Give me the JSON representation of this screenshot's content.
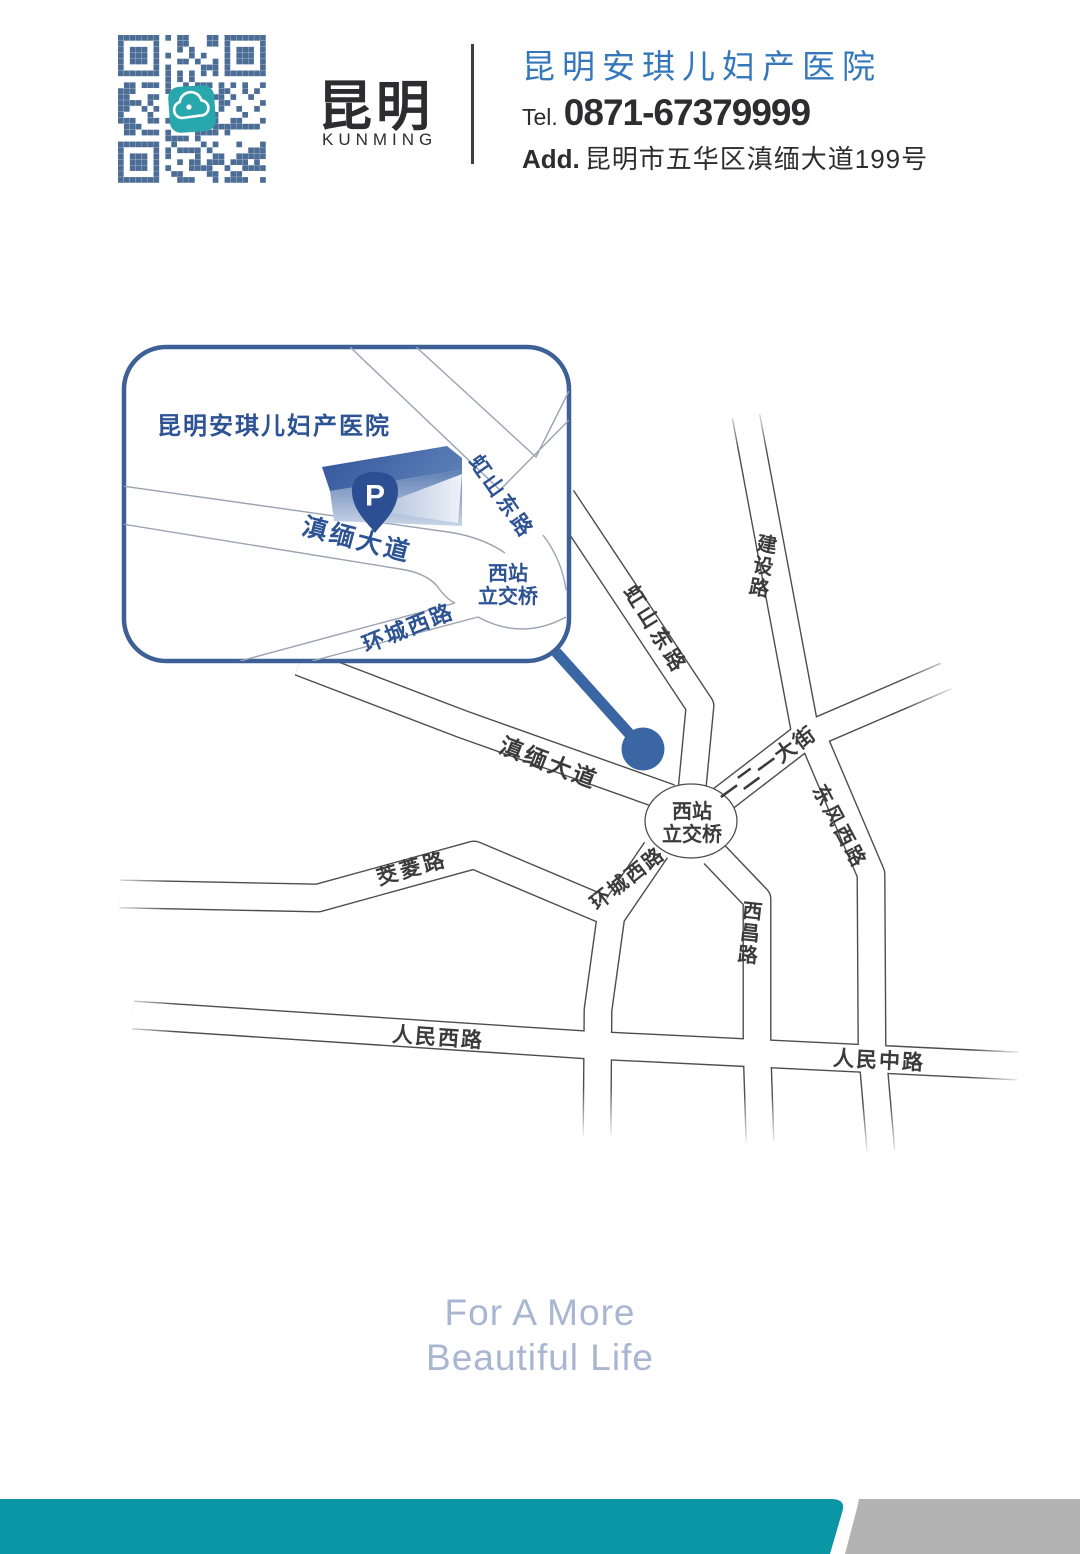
{
  "header": {
    "brand_cn": "昆明",
    "brand_en": "KUNMING",
    "hospital_name": "昆明安琪儿妇产医院",
    "tel_label": "Tel.",
    "tel_number": "0871-67379999",
    "addr_label": "Add.",
    "address": "昆明市五华区滇缅大道199号"
  },
  "inset": {
    "title": "昆明安琪儿妇产医院",
    "parking_label": "P",
    "roads": {
      "dianmian": "滇缅大道",
      "hongshan": "虹山东路",
      "huancheng": "环城西路"
    },
    "interchange": {
      "line1": "西站",
      "line2": "立交桥"
    }
  },
  "map": {
    "roads": {
      "jianshe": "建设路",
      "hongshan": "虹山东路",
      "dianmian": "滇缅大道",
      "yieryi": "一二一大街",
      "dongfeng": "东风西路",
      "huancheng": "环城西路",
      "xichang": "西昌路",
      "jiaoling": "茭菱路",
      "renmin_west": "人民西路",
      "renmin_middle": "人民中路"
    },
    "interchange": {
      "line1": "西站",
      "line2": "立交桥"
    }
  },
  "footer": {
    "slogan_line1": "For A More",
    "slogan_line2": "Beautiful Life"
  },
  "colors": {
    "header_blue": "#3577bb",
    "label_blue": "#2d5394",
    "accent_blue": "#3a66a3",
    "inset_border": "#3d6096",
    "road_line": "#4d4d4d",
    "road_label": "#3b3b3b",
    "teal_bar": "#0b96a6",
    "gray_bar": "#b3b3b3",
    "slogan": "#a8b6d2",
    "qr_blue": "#4c6d96",
    "qr_icon_teal": "#28a8ad"
  }
}
